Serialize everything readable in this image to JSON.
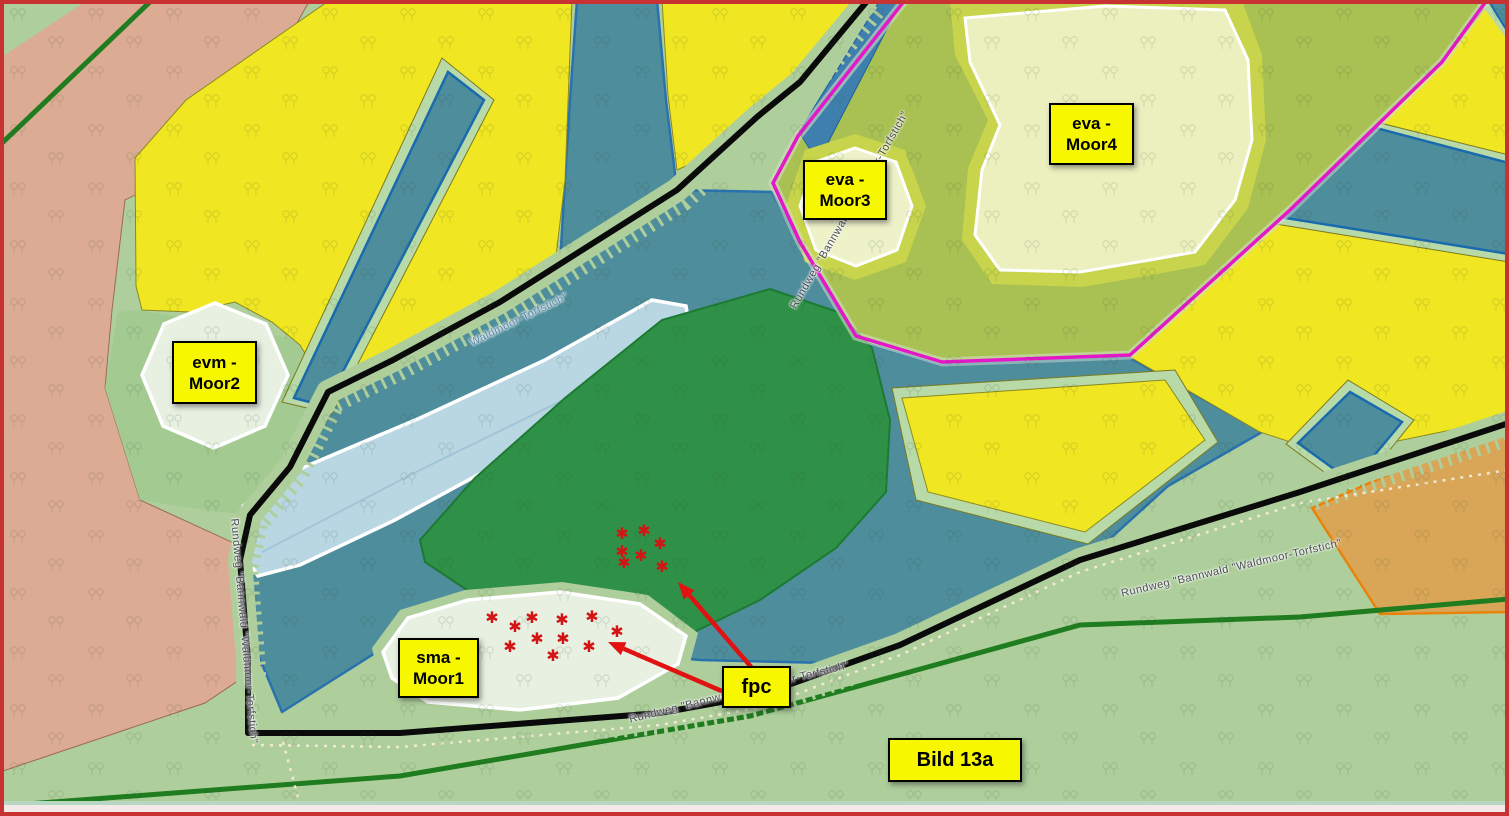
{
  "map": {
    "type": "biotope-map",
    "region_labels": [
      {
        "id": "eva-moor4",
        "line1": "eva -",
        "line2": "Moor4"
      },
      {
        "id": "eva-moor3",
        "line1": "eva -",
        "line2": "Moor3"
      },
      {
        "id": "evm-moor2",
        "line1": "evm -",
        "line2": "Moor2"
      },
      {
        "id": "sma-moor1",
        "line1": "sma -",
        "line2": "Moor1"
      },
      {
        "id": "fpc",
        "line1": "fpc"
      },
      {
        "id": "bild-13a",
        "line1": "Bild 13a"
      }
    ],
    "path_labels": [
      {
        "id": "trail-upper",
        "text": "Rundweg \"Bannwald \"Waldmoor-Torfstich\""
      },
      {
        "id": "trail-pond",
        "text": "Waldmoor-Torfstich\""
      },
      {
        "id": "trail-left",
        "text": "Rundweg \"Bannwald \"Waldmoor-Torfstich\""
      },
      {
        "id": "trail-bottom",
        "text": "Rundweg \"Bannwald \"Waldmoor-Torfstich\""
      },
      {
        "id": "trail-right",
        "text": "Rundweg \"Bannwald \"Waldmoor-Torfstich\""
      }
    ],
    "markers": {
      "glyph": "✱",
      "color": "#d21414",
      "clusters": [
        {
          "id": "forest-cluster",
          "points": [
            [
              622,
              534
            ],
            [
              644,
              531
            ],
            [
              660,
              544
            ],
            [
              622,
              552
            ],
            [
              641,
              556
            ],
            [
              624,
              563
            ],
            [
              662,
              567
            ]
          ]
        },
        {
          "id": "moor1-cluster",
          "points": [
            [
              492,
              618
            ],
            [
              532,
              618
            ],
            [
              562,
              620
            ],
            [
              592,
              617
            ],
            [
              515,
              627
            ],
            [
              617,
              632
            ],
            [
              537,
              639
            ],
            [
              563,
              639
            ],
            [
              510,
              647
            ],
            [
              589,
              647
            ],
            [
              553,
              656
            ]
          ]
        }
      ]
    },
    "arrows": {
      "color": "#e01212",
      "lines": [
        {
          "from": [
            752,
            668
          ],
          "to": [
            678,
            582
          ]
        },
        {
          "from": [
            724,
            692
          ],
          "to": [
            608,
            642
          ]
        }
      ]
    },
    "colors": {
      "background_green": "#aecf9c",
      "wetland_teal": "#4e8d9c",
      "field_yellow": "#f0e622",
      "moor_pale_green": "#e7f0e1",
      "moor_pale_yellow": "#ecf0bf",
      "forest_dark_green": "#2f9048",
      "heath_olive": "#a9c053",
      "soil_salmon": "#dcab93",
      "orange_area": "#dfa14e",
      "water_pale_blue": "#b9d7e3",
      "boundary_black": "#0a0a0a",
      "boundary_magenta": "#e318c8",
      "boundary_dark_green": "#1f7c1f",
      "label_yellow": "#f7f700",
      "marker_red": "#d21414",
      "frame_red": "#c83232"
    }
  }
}
